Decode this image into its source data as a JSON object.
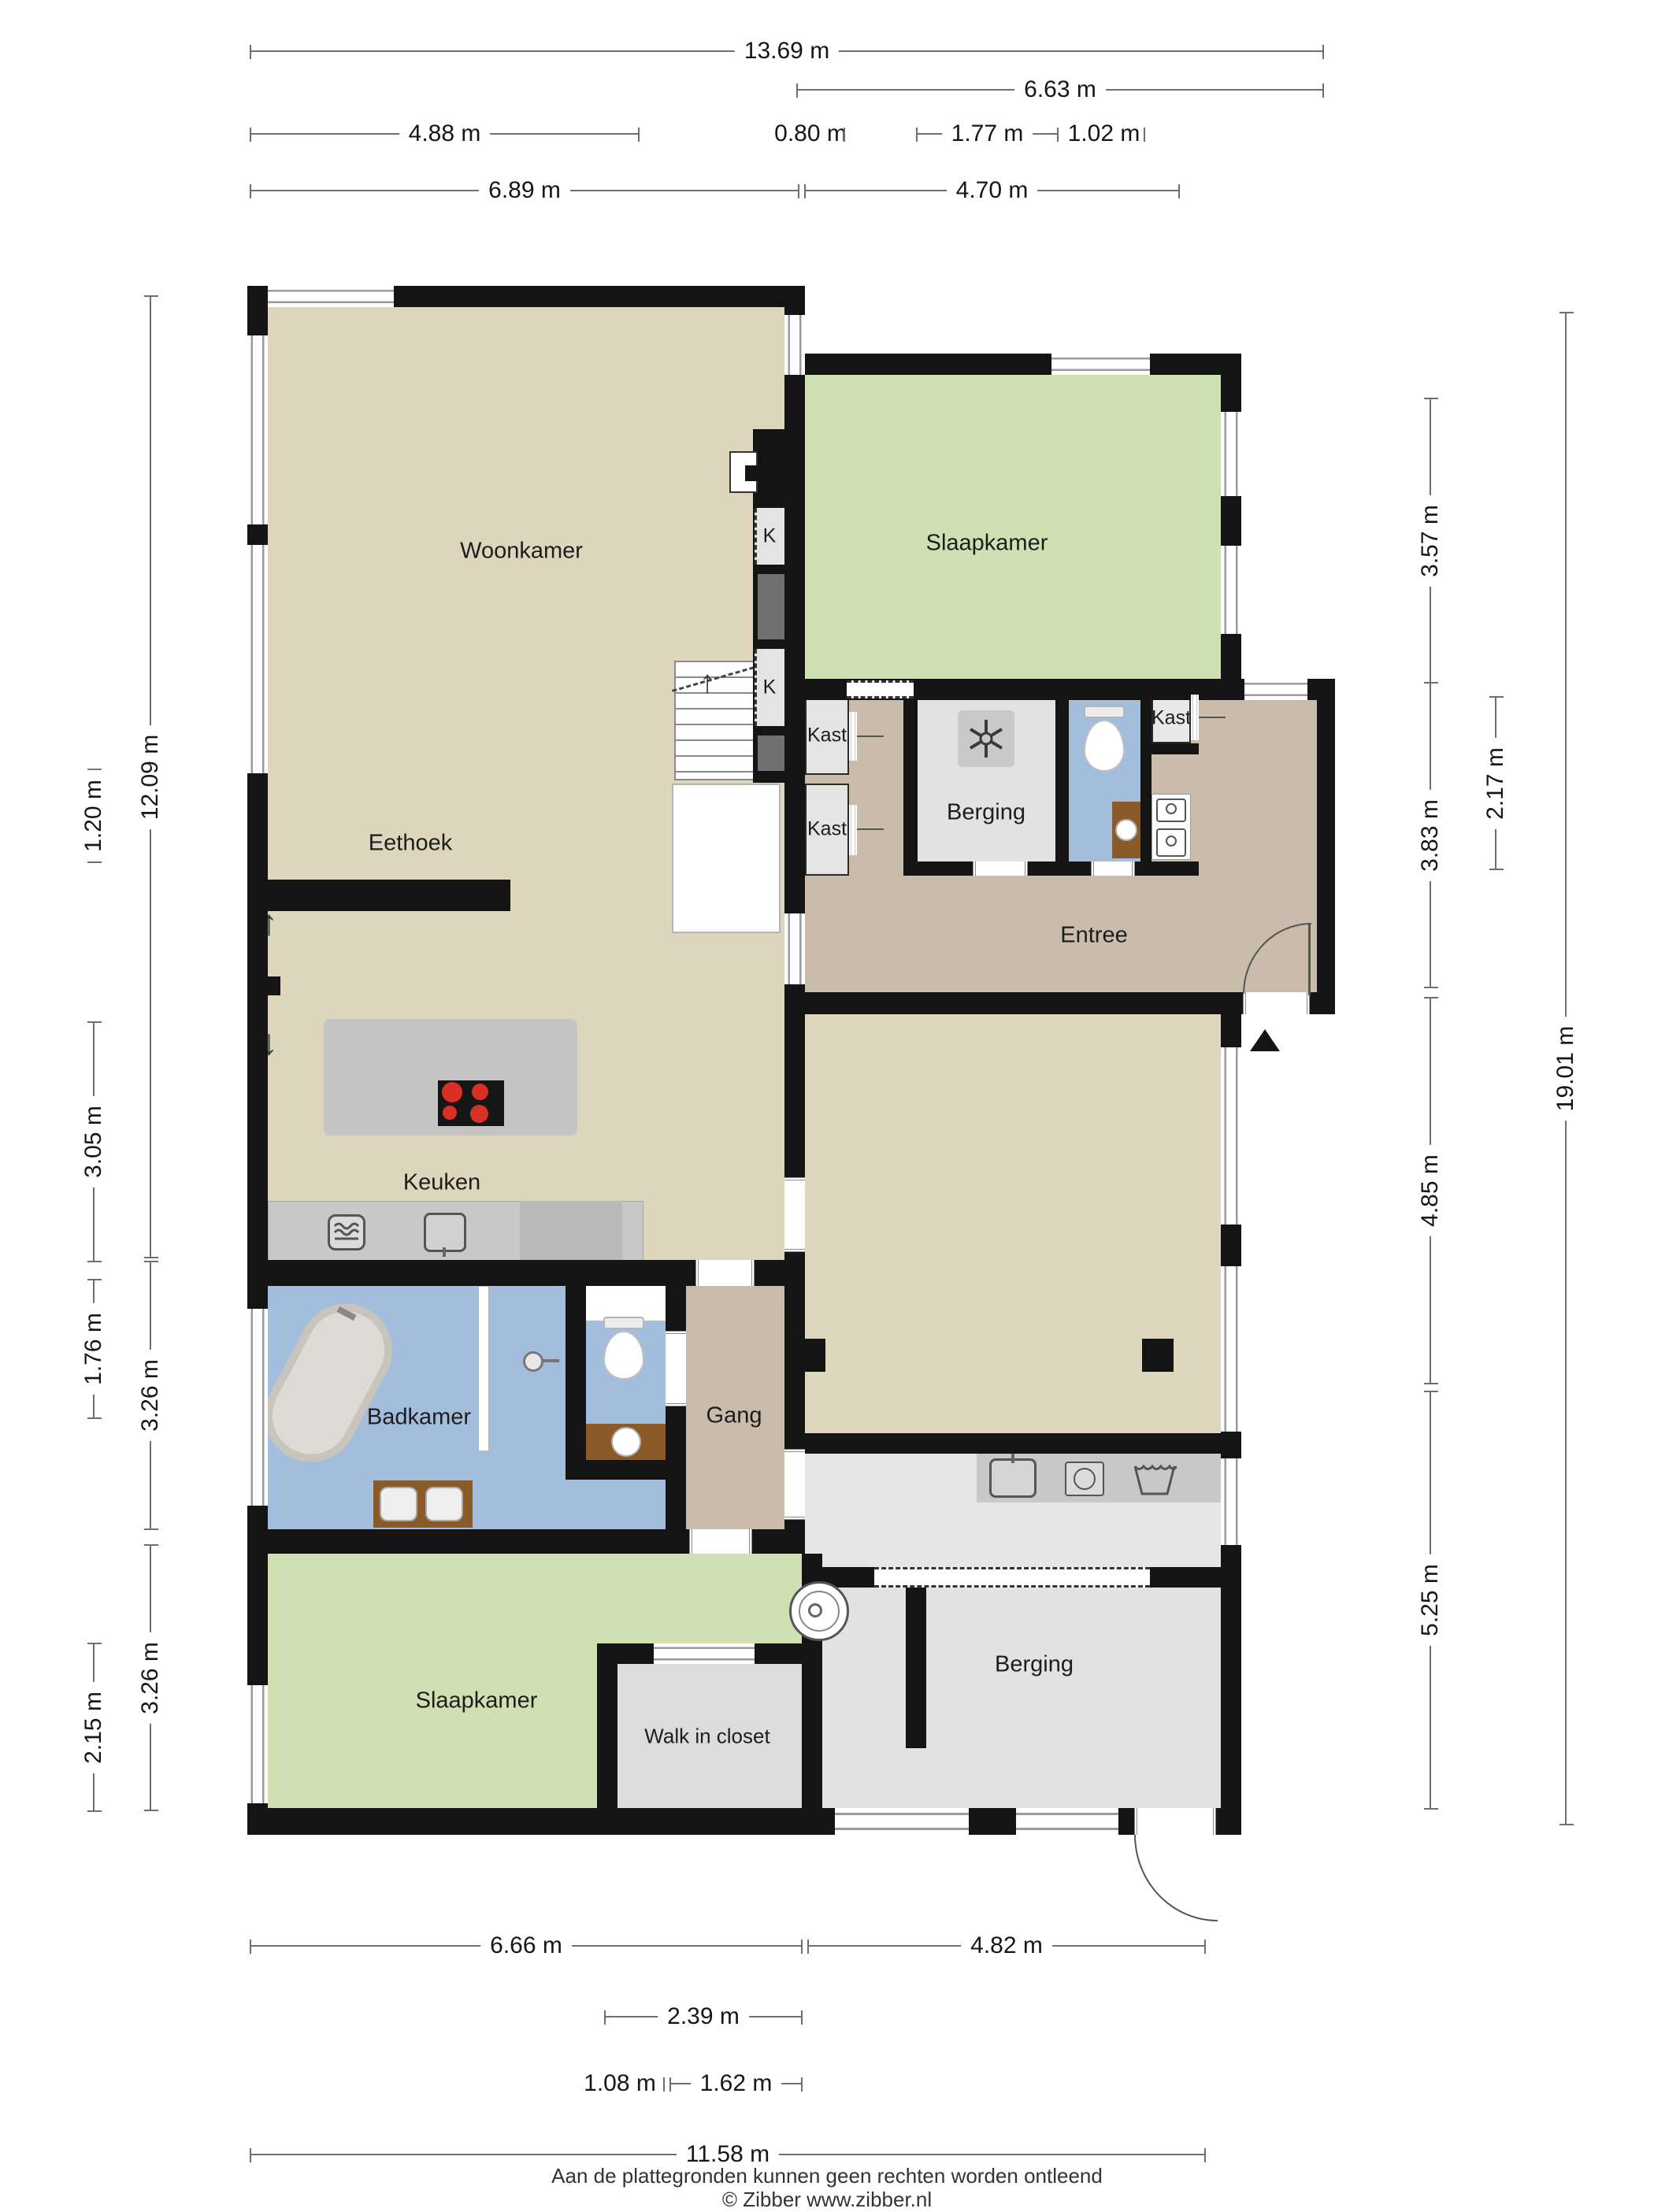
{
  "rooms": {
    "woonkamer": "Woonkamer",
    "slaapkamer_top": "Slaapkamer",
    "eethoek": "Eethoek",
    "keuken": "Keuken",
    "badkamer": "Badkamer",
    "gang": "Gang",
    "entree": "Entree",
    "berging_top": "Berging",
    "berging_bottom": "Berging",
    "slaapkamer_bottom": "Slaapkamer",
    "walk_in_closet": "Walk in closet"
  },
  "closets": {
    "k": "K",
    "kast": "Kast"
  },
  "dimensions": {
    "top": [
      "13.69 m",
      "6.63 m",
      "4.88 m",
      "0.80 m",
      "1.77 m",
      "1.02 m",
      "6.89 m",
      "4.70 m"
    ],
    "left": [
      "1.20 m",
      "3.05 m",
      "1.76 m",
      "2.15 m",
      "12.09 m",
      "3.26 m",
      "3.26 m"
    ],
    "right": [
      "3.57 m",
      "3.83 m",
      "4.85 m",
      "5.25 m",
      "2.17 m",
      "19.01 m"
    ],
    "bottom": [
      "6.66 m",
      "4.82 m",
      "2.39 m",
      "1.08 m",
      "1.62 m",
      "11.58 m"
    ]
  },
  "icons": {
    "arrow_up": "↑",
    "arrow_down": "↓"
  },
  "colors": {
    "wall": "#141414",
    "floor_living": "#ddd6bc",
    "floor_bedroom": "#cfe1b2",
    "floor_hall": "#c9bcab",
    "floor_bath": "#a3bddc",
    "floor_storage": "#e2e2e2",
    "counter": "#c8c8c8",
    "wood": "#8a5a28",
    "burner_red": "#d93025"
  },
  "footer": {
    "line1": "Aan de plattegronden kunnen geen rechten worden ontleend",
    "line2": "© Zibber www.zibber.nl"
  }
}
